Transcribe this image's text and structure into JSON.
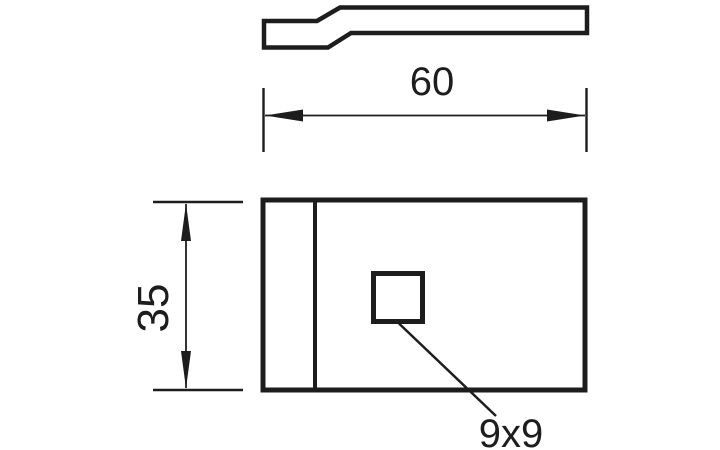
{
  "drawing": {
    "colors": {
      "line": "#1d1d1d",
      "background": "#ffffff"
    },
    "labels": {
      "width": "60",
      "height": "35",
      "hole": "9x9"
    }
  }
}
